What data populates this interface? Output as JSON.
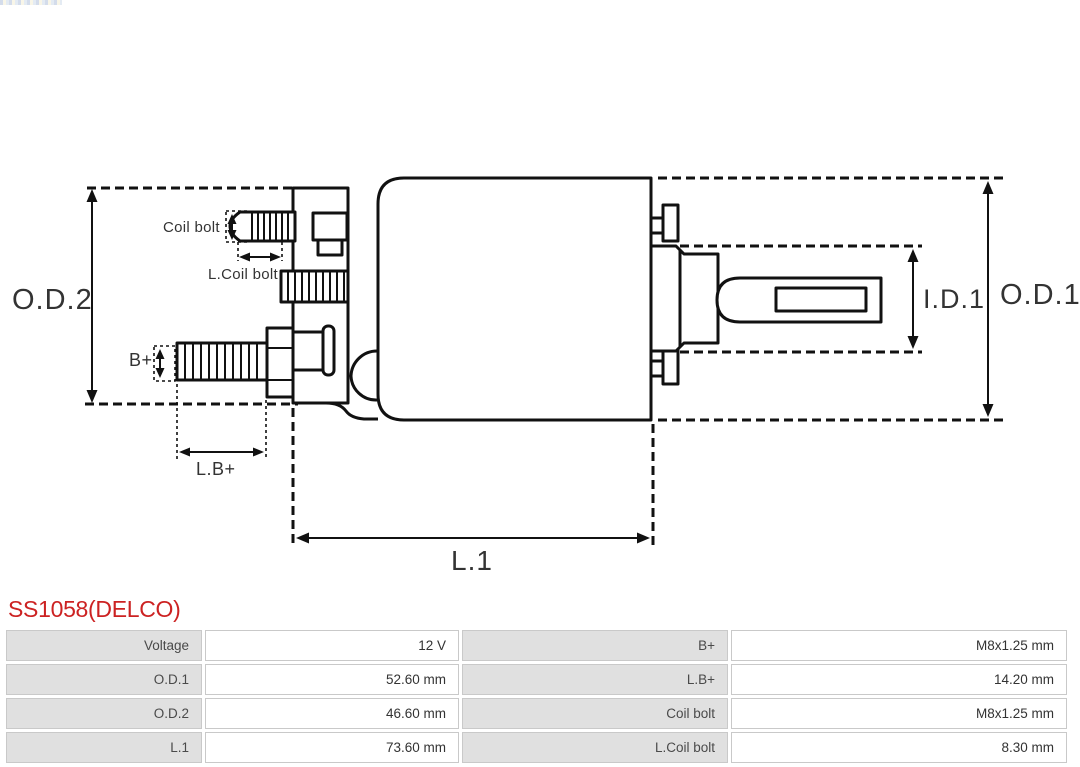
{
  "title": {
    "text": "SS1058(DELCO)",
    "color": "#cc2222"
  },
  "diagram": {
    "line_color": "#111111",
    "labels": {
      "od2": "O.D.2",
      "od1": "O.D.1",
      "id1": "I.D.1",
      "l1": "L.1",
      "lb_plus": "L.B+",
      "b_plus": "B+",
      "coil_bolt": "Coil bolt",
      "l_coil_bolt": "L.Coil bolt"
    }
  },
  "spec_table": {
    "colors": {
      "label_bg": "#e0e0e0",
      "value_bg": "#ffffff",
      "border": "#c9c9c9"
    },
    "rows": [
      {
        "label_left": "Voltage",
        "value_left": "12 V",
        "label_right": "B+",
        "value_right": "M8x1.25 mm"
      },
      {
        "label_left": "O.D.1",
        "value_left": "52.60 mm",
        "label_right": "L.B+",
        "value_right": "14.20 mm"
      },
      {
        "label_left": "O.D.2",
        "value_left": "46.60 mm",
        "label_right": "Coil bolt",
        "value_right": "M8x1.25 mm"
      },
      {
        "label_left": "L.1",
        "value_left": "73.60 mm",
        "label_right": "L.Coil bolt",
        "value_right": "8.30 mm"
      }
    ]
  }
}
